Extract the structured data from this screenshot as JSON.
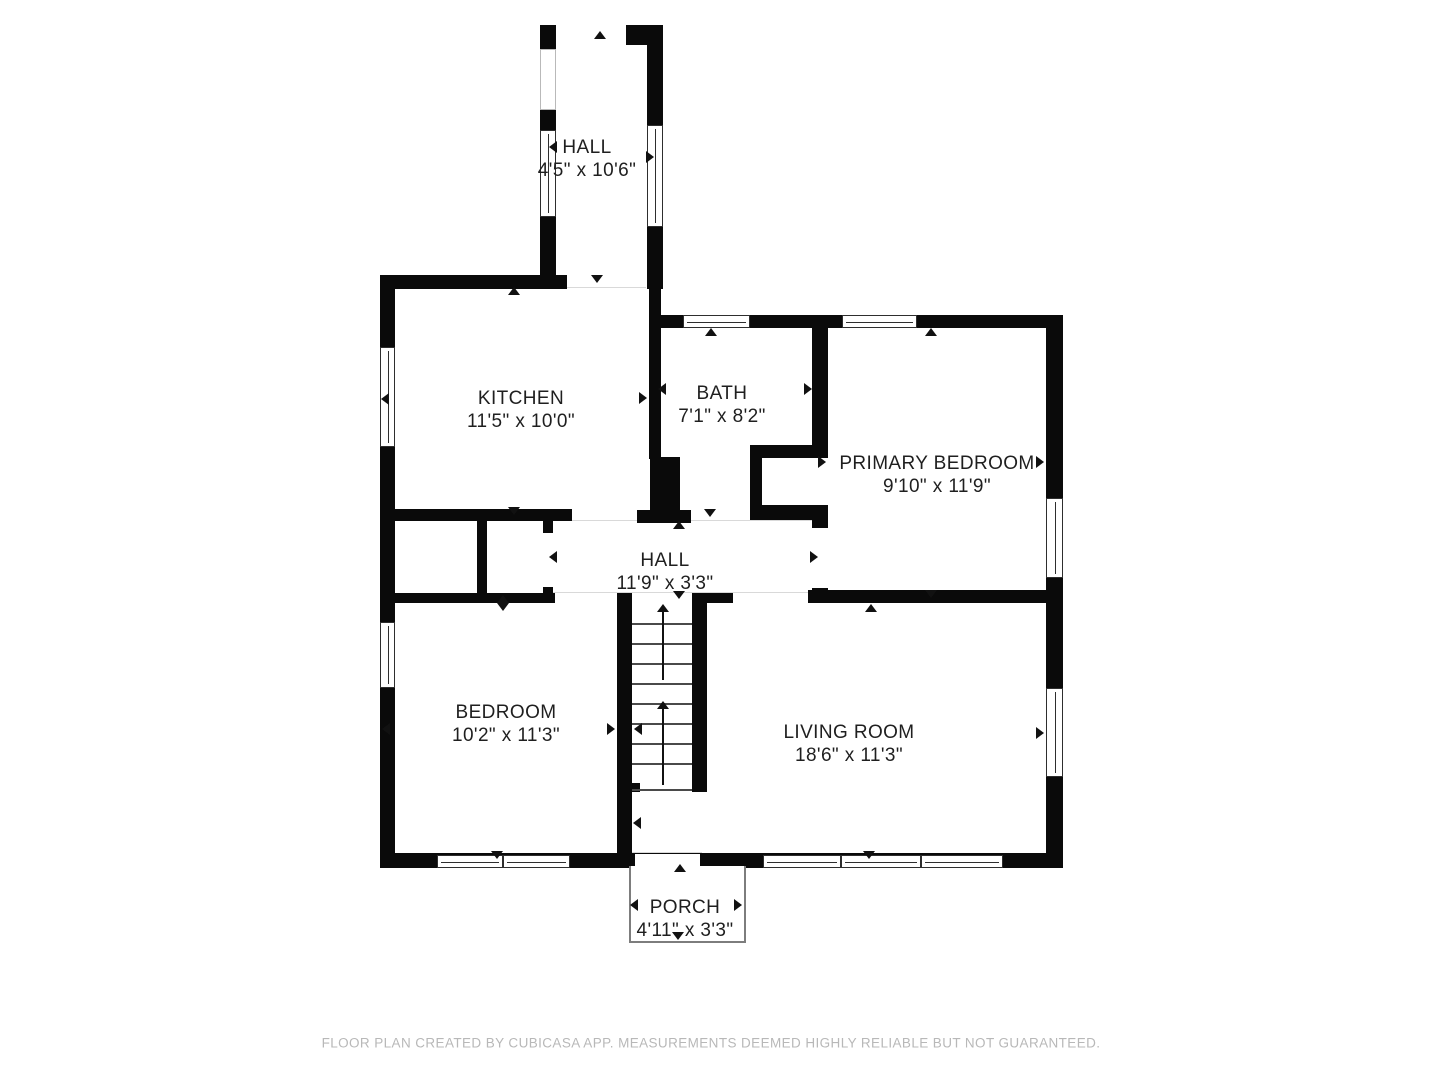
{
  "rooms": [
    {
      "id": "entry-hall",
      "name": "HALL",
      "dimensions": "4'5\" x 10'6\""
    },
    {
      "id": "kitchen",
      "name": "KITCHEN",
      "dimensions": "11'5\" x 10'0\""
    },
    {
      "id": "bath",
      "name": "BATH",
      "dimensions": "7'1\" x 8'2\""
    },
    {
      "id": "primary-bedroom",
      "name": "PRIMARY BEDROOM",
      "dimensions": "9'10\" x 11'9\""
    },
    {
      "id": "hall",
      "name": "HALL",
      "dimensions": "11'9\" x 3'3\""
    },
    {
      "id": "bedroom",
      "name": "BEDROOM",
      "dimensions": "10'2\" x 11'3\""
    },
    {
      "id": "living-room",
      "name": "LIVING ROOM",
      "dimensions": "18'6\" x 11'3\""
    },
    {
      "id": "porch",
      "name": "PORCH",
      "dimensions": "4'11\" x 3'3\""
    }
  ],
  "footer": {
    "disclaimer": "FLOOR PLAN CREATED BY CUBICASA APP. MEASUREMENTS DEEMED HIGHLY RELIABLE BUT NOT GUARANTEED."
  },
  "colors": {
    "wall": "#0a0a0a",
    "background": "#ffffff",
    "label_text": "#1f1f1f",
    "footer_text": "#b8b8b8"
  }
}
